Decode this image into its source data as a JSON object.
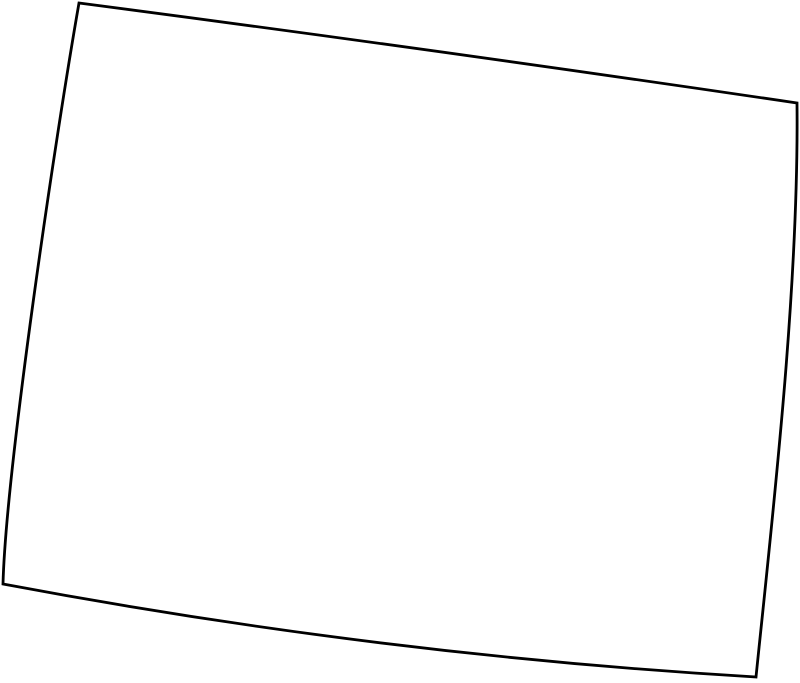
{
  "canvas": {
    "width": 800,
    "height": 683,
    "background_color": "#ffffff"
  },
  "map": {
    "description": "Blank outline map of a roughly rectangular region resembling the U.S. state of Wyoming, tilted clockwise, with slightly curved borders",
    "outline_color": "#000000",
    "fill_color": "#ffffff",
    "stroke_width": "2.8",
    "viewbox": "0 0 800 683",
    "path": "M 79 3 Q 438 50 797 103 C 799 290 772 520 756 677 Q 380 655 3 584 C 6 470 55 140 79 3 Z",
    "corners": {
      "top_left": "79,3",
      "top_right": "797,103",
      "bottom_right": "756,677",
      "bottom_left": "3,584"
    }
  }
}
